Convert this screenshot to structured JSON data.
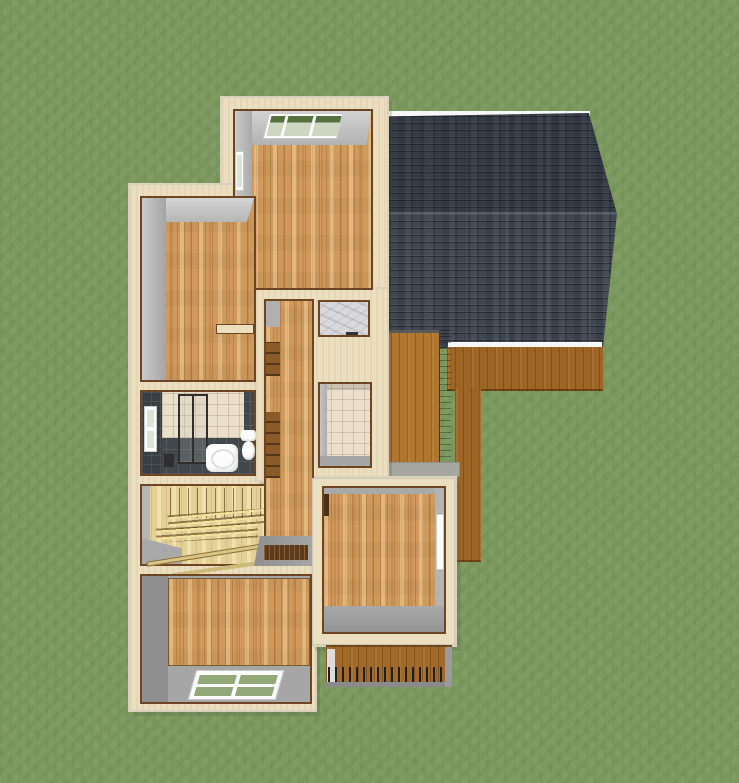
{
  "scene": {
    "description": "3D overhead dollhouse render of a house second-floor plan set on a grass lawn",
    "render_style": "home-design-software perspective render",
    "view": "top-down cutaway"
  },
  "colors": {
    "grass": "#7d9a5f",
    "stucco": "#ecdfc0",
    "wallEdge": "#6e4522",
    "wallGray": "#b9b9b9",
    "wood": "#d09a5c",
    "stairWood": "#e3d096",
    "roof": "#3d434e",
    "fascia": "#f7f7f7",
    "sidingOrange": "#b0752e",
    "sidingBrown": "#9c6526",
    "tileDark": "#42474c",
    "tileBeige": "#e9dfca",
    "marble": "#d9d9dd",
    "fixtureWhite": "#fcfcfc",
    "glassGreen": "#93a878",
    "glassPale": "#dde3d6",
    "landing": "#9b9b9b",
    "floorBoardsDark": "#5d3a1c",
    "railDark": "#1f1f1f",
    "railGray": "#8a8a8a"
  },
  "elements": {
    "rooms": [
      "bedroom-top",
      "bedroom-left",
      "bathroom",
      "hallway",
      "marble-closet",
      "tiled-room",
      "stairwell",
      "bedroom-bottom",
      "room-right"
    ],
    "fixtures": [
      "shower-enclosure",
      "sink",
      "toilet",
      "staircase-with-railing"
    ],
    "exterior": [
      "shingle-roof",
      "wood-siding-walls",
      "deck-with-railing",
      "lawn"
    ],
    "windows_count": 5
  }
}
